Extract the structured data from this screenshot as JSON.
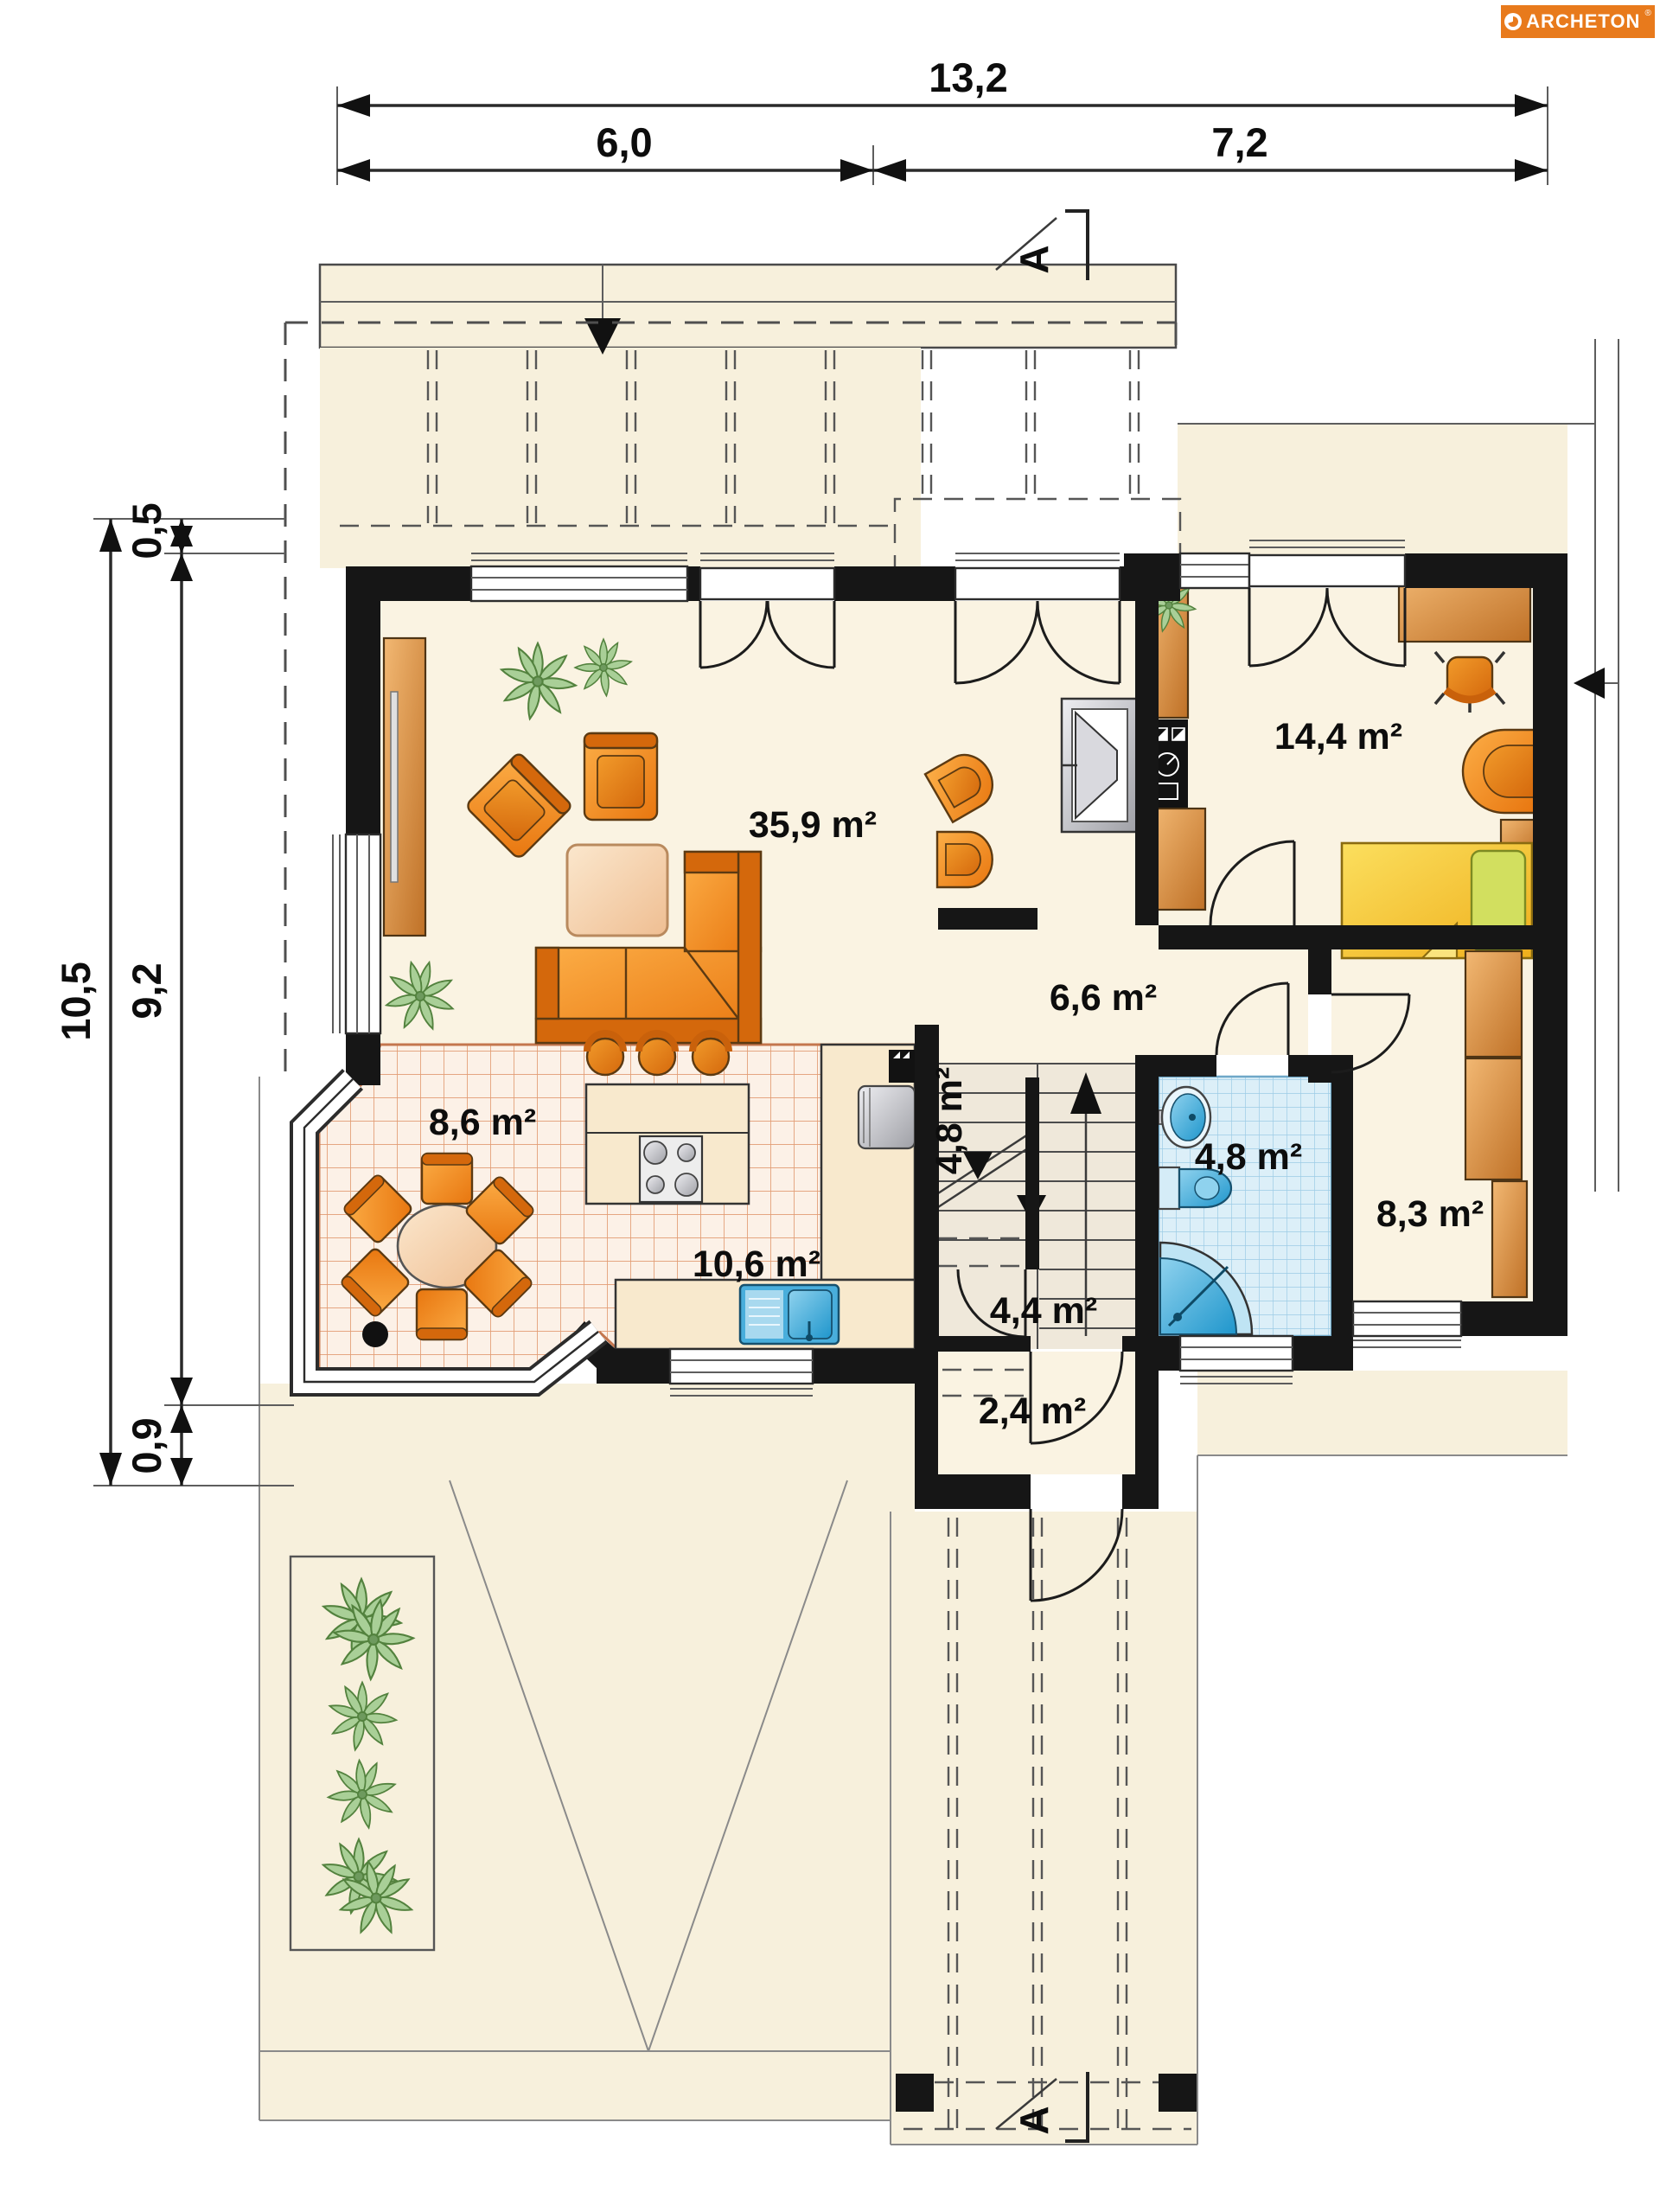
{
  "logo": {
    "brand": "ARCHETON",
    "registered": "®",
    "icon": "sunburst-logo-icon",
    "bg_color": "#E87A1C"
  },
  "plan": {
    "type": "floor-plan",
    "level": "ground-floor"
  },
  "rooms": [
    {
      "id": "living-room",
      "area_label": "35,9 m²"
    },
    {
      "id": "bedroom",
      "area_label": "14,4 m²"
    },
    {
      "id": "hall",
      "area_label": "6,6 m²"
    },
    {
      "id": "dining-nook",
      "area_label": "8,6 m²"
    },
    {
      "id": "kitchen",
      "area_label": "10,6 m²"
    },
    {
      "id": "staircase",
      "area_label": "4,8 m²"
    },
    {
      "id": "bathroom",
      "area_label": "4,8 m²"
    },
    {
      "id": "storage-room",
      "area_label": "8,3 m²"
    },
    {
      "id": "entry",
      "area_label": "4,4 m²"
    },
    {
      "id": "vestibule",
      "area_label": "2,4 m²"
    }
  ],
  "dimensions": {
    "unit": "m",
    "top": [
      {
        "name": "overall-width",
        "label": "13,2"
      },
      {
        "name": "left-span",
        "label": "6,0"
      },
      {
        "name": "right-span",
        "label": "7,2"
      }
    ],
    "left": [
      {
        "name": "offset-top",
        "label": "0,5"
      },
      {
        "name": "overall-depth",
        "label": "10,5"
      },
      {
        "name": "main-depth",
        "label": "9,2"
      },
      {
        "name": "offset-bottom",
        "label": "0,9"
      }
    ]
  },
  "section_markers": {
    "top": "A",
    "bottom": "A"
  },
  "colors": {
    "wall": "#161616",
    "floor_cream": "#FAF3E2",
    "furniture_orange": "#EF8318",
    "wood_copper": "#D78A43",
    "bed_yellow": "#F5C832",
    "water_blue": "#2FA3D6",
    "bath_tile": "#DCEFF8",
    "kitchen_tile_line": "#D98459",
    "plant_green": "#A9CF97",
    "logo_orange": "#E87A1C"
  }
}
